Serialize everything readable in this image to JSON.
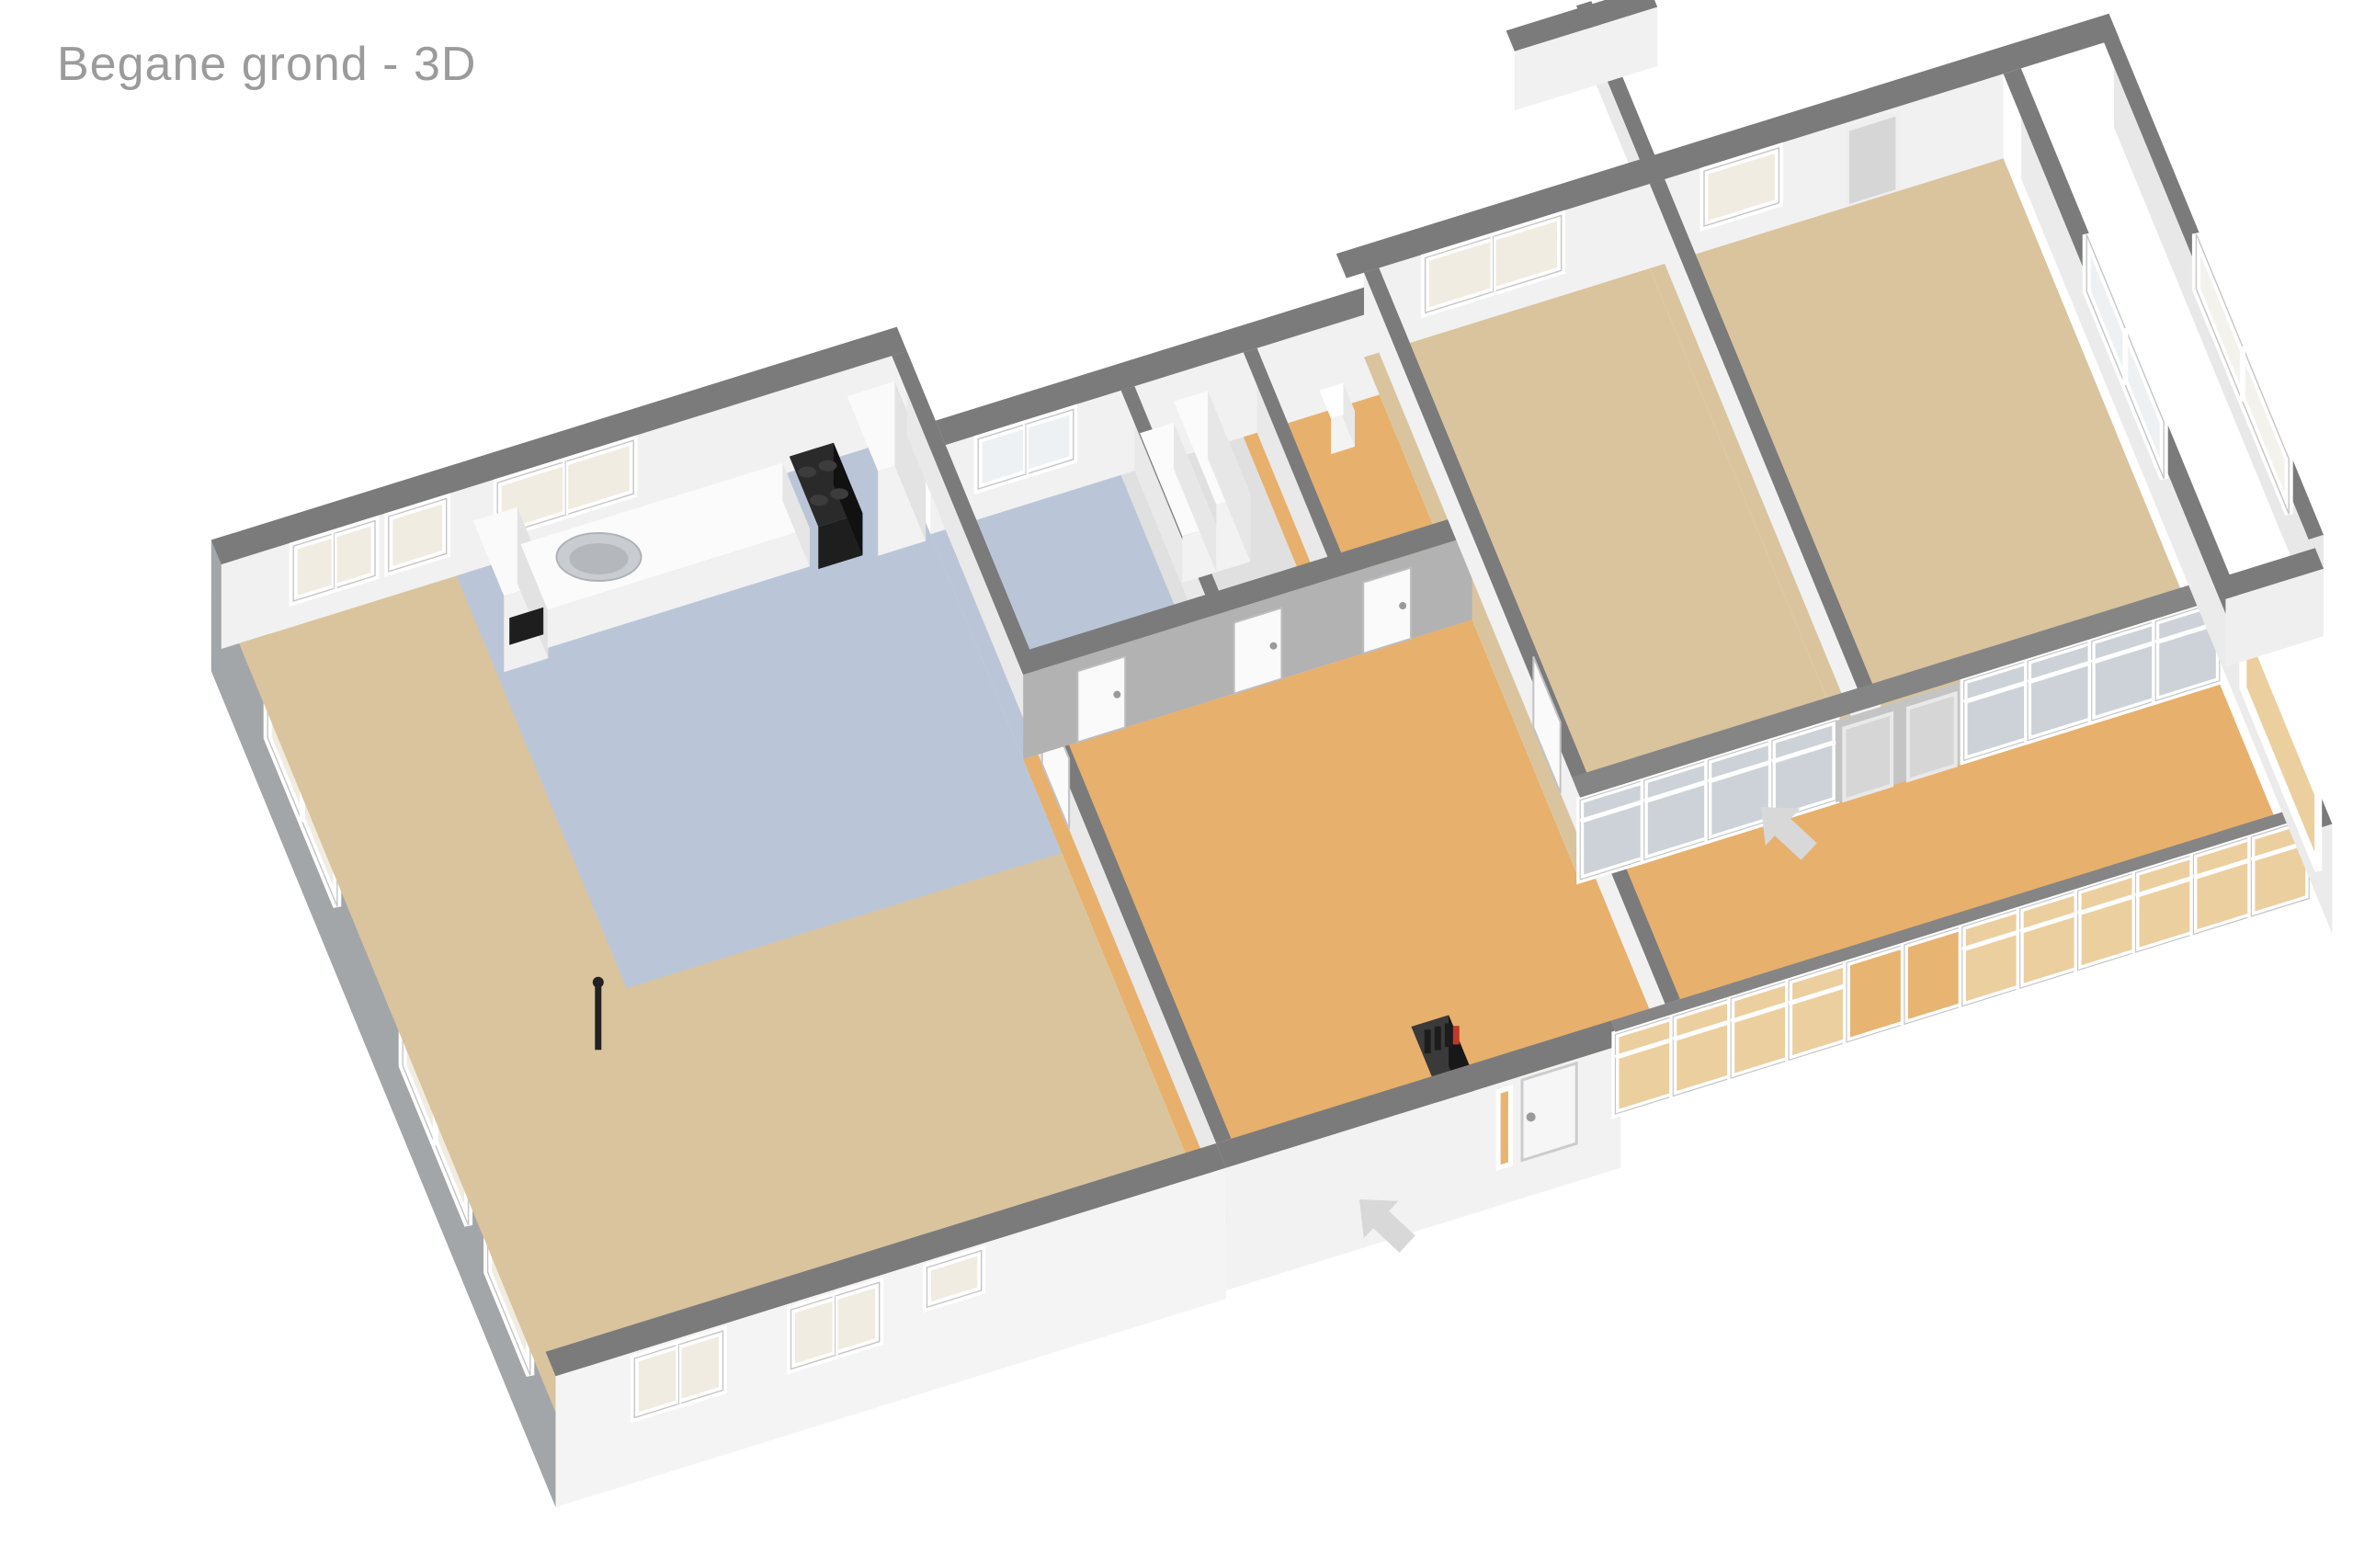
{
  "title": "Begane grond - 3D",
  "palette": {
    "background": "#ffffff",
    "title_text": "#9b9b9b",
    "wall_top": "#7b7b7b",
    "wall_top_glass": "#858585",
    "wall_front_white": "#f4f4f4",
    "wall_side_gray": "#a2a6a9",
    "wall_inner_light": "#f1f1f1",
    "wall_inner_gray": "#b2b2b2",
    "wall_inner_soft": "#e9e9e9",
    "floor_wood": "#d9c49e",
    "floor_terrace": "#e7b06c",
    "floor_kitchen_bath": "#bac6d8",
    "floor_storage": "#e0e0e0",
    "glass_cream": "#f0ece1",
    "glass_cool": "#eef1f3",
    "glass_terrace": "#eccf9f",
    "glass_terrace_door": "#e7b472",
    "glass_inner": "#cdd2d8",
    "window_frame": "#ffffff",
    "frame_outline": "#c6c6c6",
    "door_white": "#fafafa",
    "door_gray": "#d6d6d6",
    "appliance_dark": "#1e1e1e",
    "steel": "#c9cdd1",
    "accent_red": "#c0392b",
    "arrow": "#d8d8d8"
  },
  "icons": {
    "entrance_arrow": "arrow-entrance-icon",
    "terrace_arrow": "arrow-terrace-icon"
  }
}
